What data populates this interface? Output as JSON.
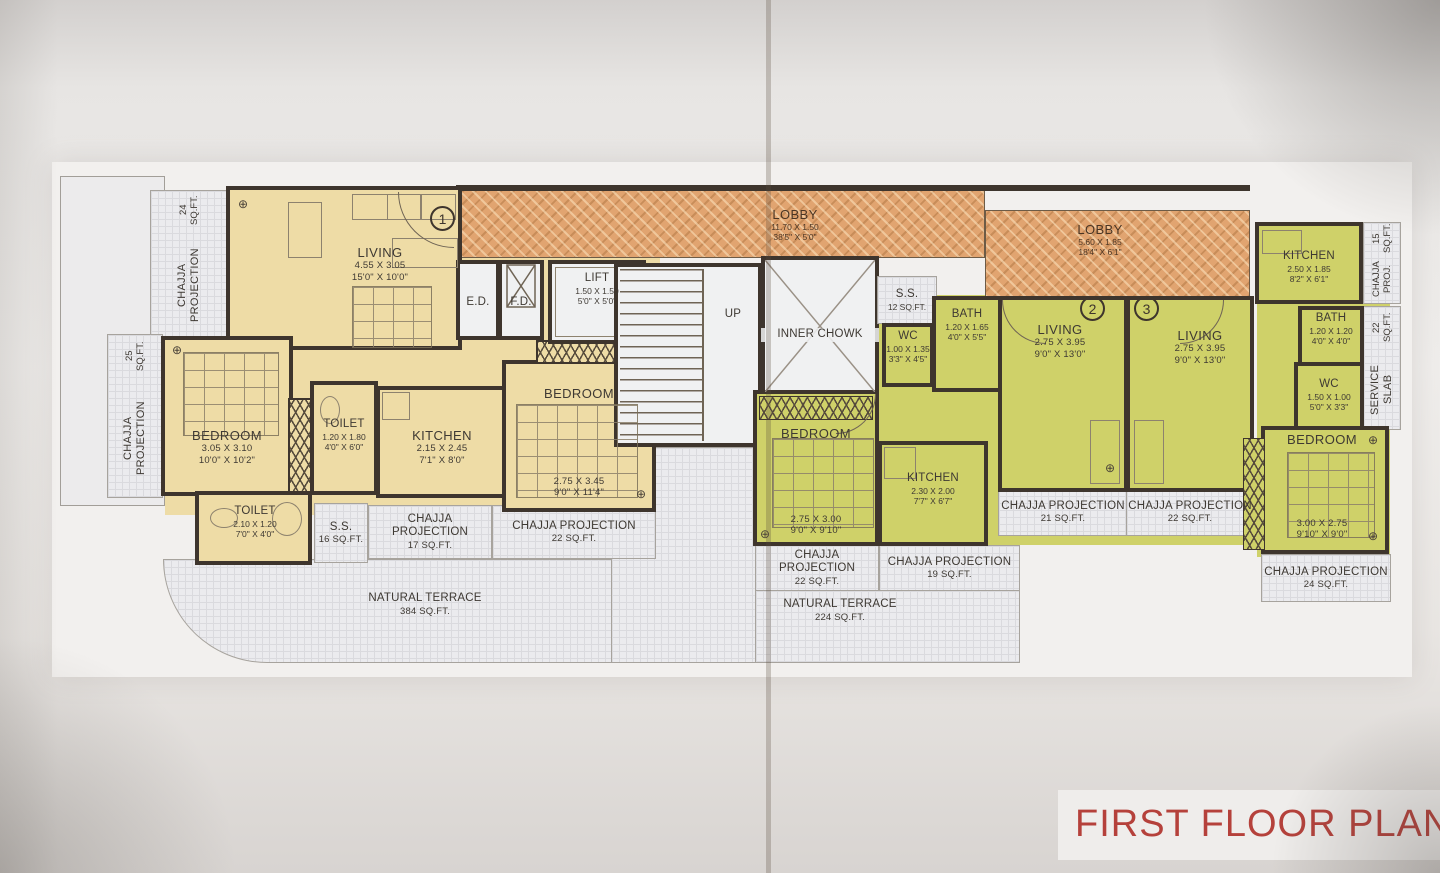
{
  "title": "FIRST FLOOR PLAN",
  "units": {
    "flat1": "1",
    "flat2": "2",
    "flat3": "3"
  },
  "misc": {
    "up": "UP",
    "ed": "E.D.",
    "fd": "F.D.",
    "inner_chowk": "INNER CHOWK"
  },
  "icons": {
    "column_marker": "⊕"
  },
  "rooms": {
    "living1": {
      "name": "LIVING",
      "m": "4.55 X 3.05",
      "ft": "15'0\" X 10'0\""
    },
    "bedroom1": {
      "name": "BEDROOM",
      "m": "3.05 X 3.10",
      "ft": "10'0\" X 10'2\""
    },
    "toilet1": {
      "name": "TOILET",
      "m": "1.20 X 1.80",
      "ft": "4'0\" X 6'0\""
    },
    "kitchen1": {
      "name": "KITCHEN",
      "m": "2.15 X 2.45",
      "ft": "7'1\" X 8'0\""
    },
    "bedroom2": {
      "name": "BEDROOM",
      "m": "2.75 X 3.45",
      "ft": "9'0\" X 11'4\""
    },
    "toilet2": {
      "name": "TOILET",
      "m": "2.10 X 1.20",
      "ft": "7'0\" X 4'0\""
    },
    "lift": {
      "name": "LIFT",
      "m": "1.50 X 1.50",
      "ft": "5'0\" X 5'0\""
    },
    "lobby1": {
      "name": "LOBBY",
      "m": "11.70 X 1.50",
      "ft": "38'5\" X 5'0\""
    },
    "lobby2": {
      "name": "LOBBY",
      "m": "5.60 X 1.85",
      "ft": "18'4\" X 6'1\""
    },
    "wc_mid": {
      "name": "WC",
      "m": "1.00 X 1.35",
      "ft": "3'3\" X 4'5\""
    },
    "bath_mid": {
      "name": "BATH",
      "m": "1.20 X 1.65",
      "ft": "4'0\" X 5'5\""
    },
    "living2": {
      "name": "LIVING",
      "m": "2.75 X 3.95",
      "ft": "9'0\" X 13'0\""
    },
    "living3": {
      "name": "LIVING",
      "m": "2.75 X 3.95",
      "ft": "9'0\" X 13'0\""
    },
    "bedroom3": {
      "name": "BEDROOM",
      "m": "2.75 X 3.00",
      "ft": "9'0\" X 9'10\""
    },
    "kitchen2": {
      "name": "KITCHEN",
      "m": "2.30 X 2.00",
      "ft": "7'7\" X 6'7\""
    },
    "kitchen3": {
      "name": "KITCHEN",
      "m": "2.50 X 1.85",
      "ft": "8'2\" X 6'1\""
    },
    "bath3": {
      "name": "BATH",
      "m": "1.20 X 1.20",
      "ft": "4'0\" X 4'0\""
    },
    "wc3": {
      "name": "WC",
      "m": "1.50 X 1.00",
      "ft": "5'0\" X 3'3\""
    },
    "bedroom4": {
      "name": "BEDROOM",
      "m": "3.00 X 2.75",
      "ft": "9'10\" X 9'0\""
    }
  },
  "areas": {
    "chajja_tl": {
      "l1": "CHAJJA PROJECTION",
      "l2": "24 SQ.FT."
    },
    "chajja_left": {
      "l1": "CHAJJA PROJECTION",
      "l2": "25 SQ.FT."
    },
    "ss16": {
      "l1": "S.S.",
      "l2": "16 SQ.FT."
    },
    "ss12": {
      "l1": "S.S.",
      "l2": "12 SQ.FT."
    },
    "chajja17": {
      "l1": "CHAJJA PROJECTION",
      "l2": "17 SQ.FT."
    },
    "chajja22a": {
      "l1": "CHAJJA PROJECTION",
      "l2": "22 SQ.FT."
    },
    "terrace384": {
      "l1": "NATURAL TERRACE",
      "l2": "384 SQ.FT."
    },
    "terrace224": {
      "l1": "NATURAL TERRACE",
      "l2": "224 SQ.FT."
    },
    "chajja22c": {
      "l1": "CHAJJA PROJECTION",
      "l2": "22 SQ.FT."
    },
    "chajja19": {
      "l1": "CHAJJA PROJECTION",
      "l2": "19 SQ.FT."
    },
    "chajja21": {
      "l1": "CHAJJA PROJECTION",
      "l2": "21 SQ.FT."
    },
    "chajja22b": {
      "l1": "CHAJJA PROJECTION",
      "l2": "22 SQ.FT."
    },
    "chajja15": {
      "l1": "CHAJJA PROJ.",
      "l2": "15 SQ.FT."
    },
    "service_slab": {
      "l1": "SERVICE SLAB",
      "l2": "22 SQ.FT."
    },
    "chajja24b": {
      "l1": "CHAJJA PROJECTION",
      "l2": "24 SQ.FT."
    }
  },
  "colors": {
    "unit1_fill": "#eedca6",
    "unit23_fill": "#cfd169",
    "lobby_fill": "#e1a470",
    "wall": "#3e352d",
    "title_red": "#b5413b"
  }
}
